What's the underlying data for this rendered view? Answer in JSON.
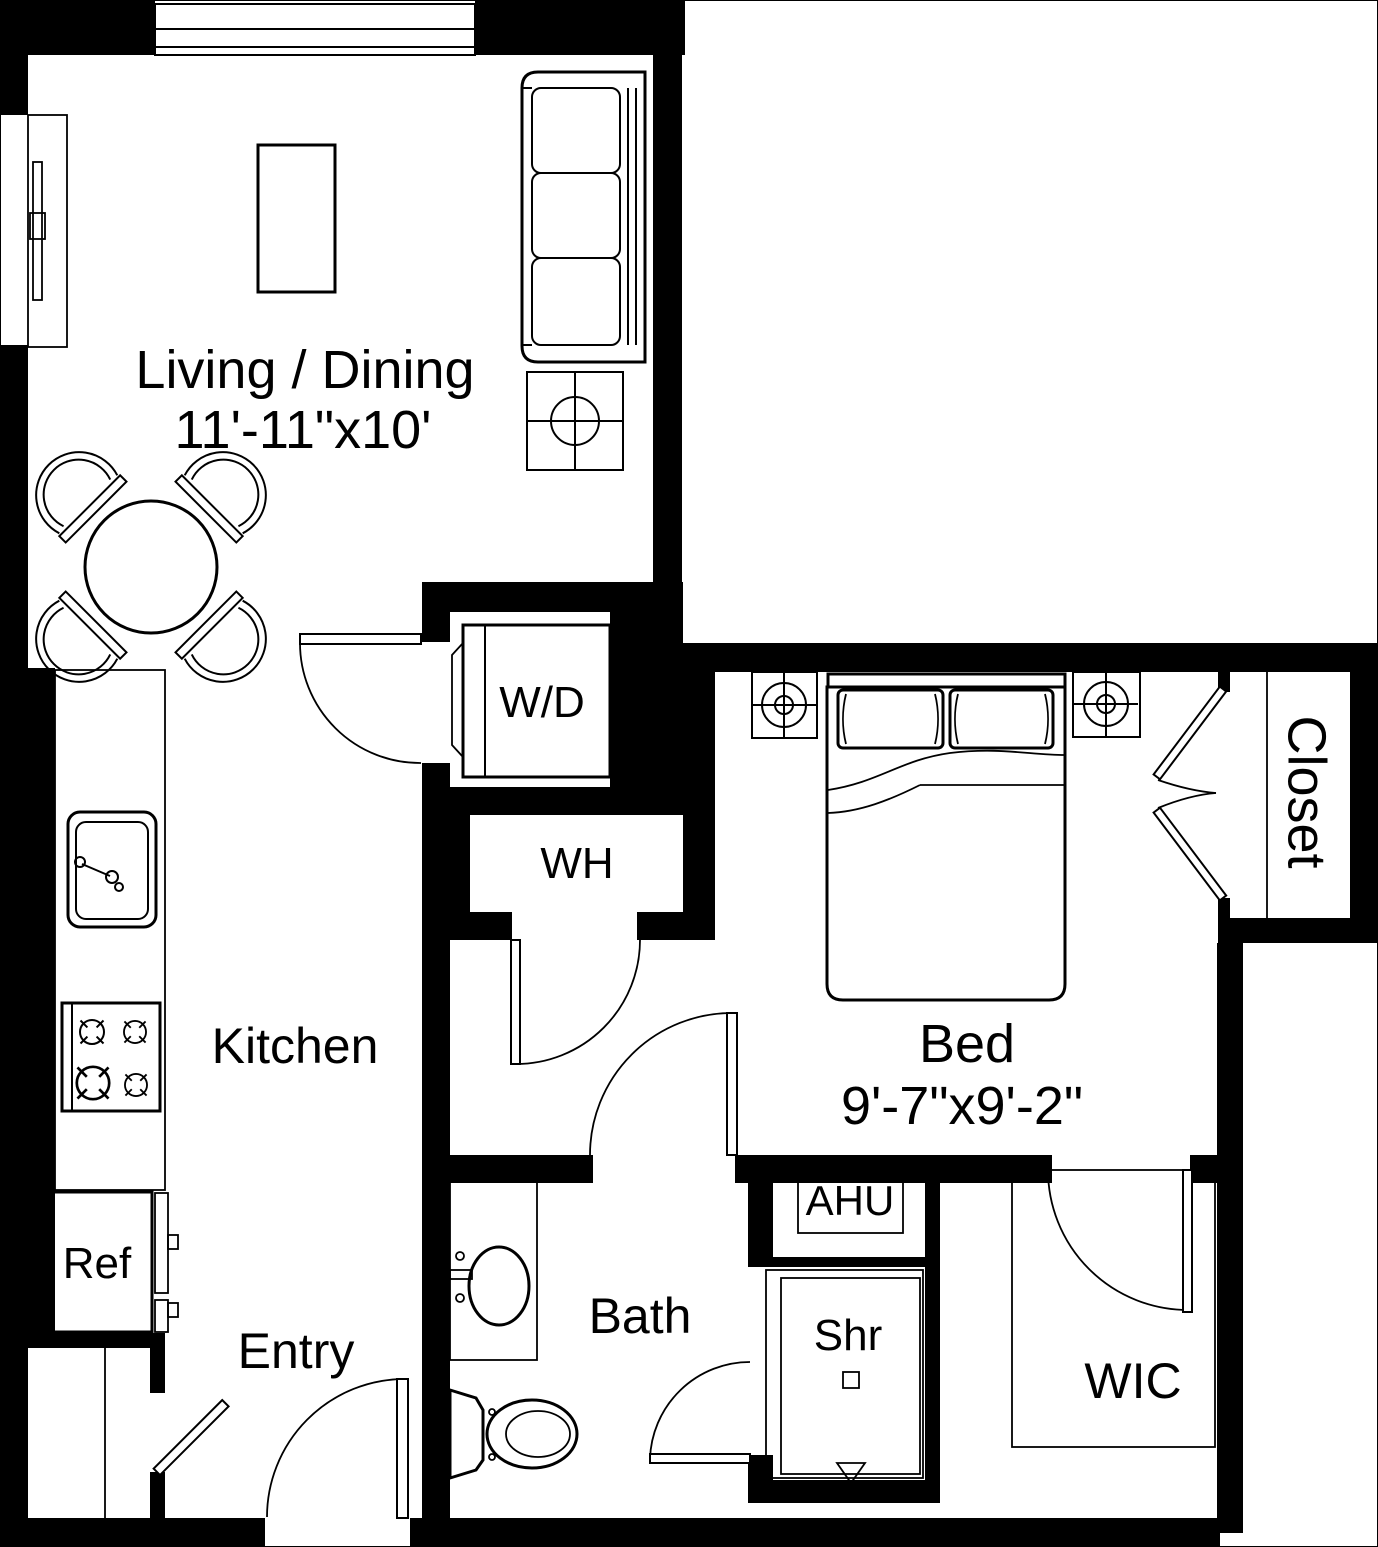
{
  "floorplan": {
    "rooms": {
      "living_dining": {
        "label": "Living / Dining",
        "dimensions": "11'-11\"x10'"
      },
      "bed": {
        "label": "Bed",
        "dimensions": "9'-7\"x9'-2\""
      },
      "kitchen": {
        "label": "Kitchen"
      },
      "bath": {
        "label": "Bath"
      },
      "entry": {
        "label": "Entry"
      },
      "wic": {
        "label": "WIC"
      },
      "closet": {
        "label": "Closet"
      }
    },
    "fixtures": {
      "washer_dryer": {
        "label": "W/D"
      },
      "water_heater": {
        "label": "WH"
      },
      "air_handler": {
        "label": "AHU"
      },
      "shower": {
        "label": "Shr"
      },
      "refrigerator": {
        "label": "Ref"
      }
    },
    "colors": {
      "wall": "#000000",
      "background": "#ffffff",
      "line": "#000000"
    }
  }
}
